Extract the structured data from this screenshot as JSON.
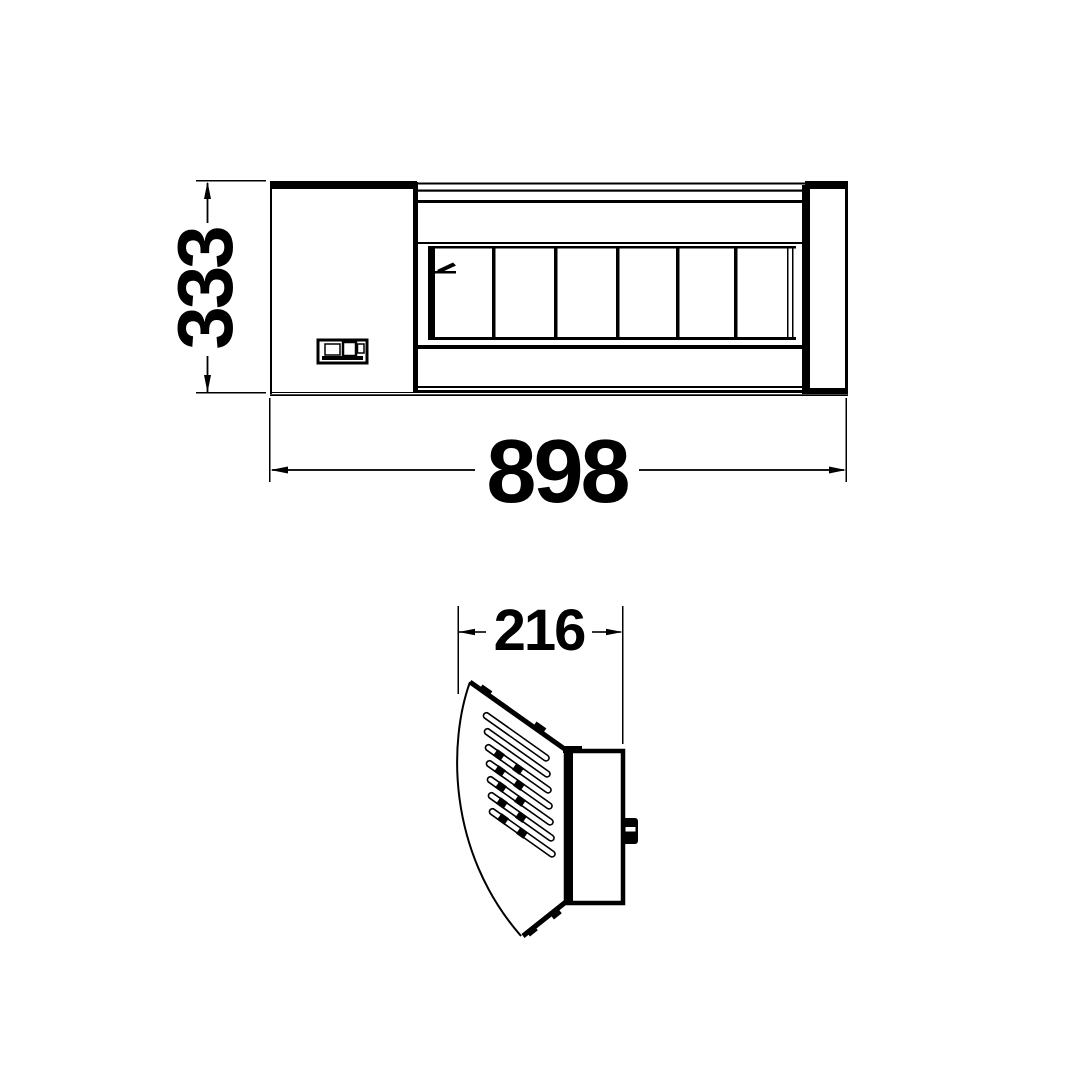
{
  "colors": {
    "background": "#ffffff",
    "line": "#000000",
    "text": "#000000"
  },
  "dimensions": {
    "height": "333",
    "width": "898",
    "depth": "216"
  }
}
